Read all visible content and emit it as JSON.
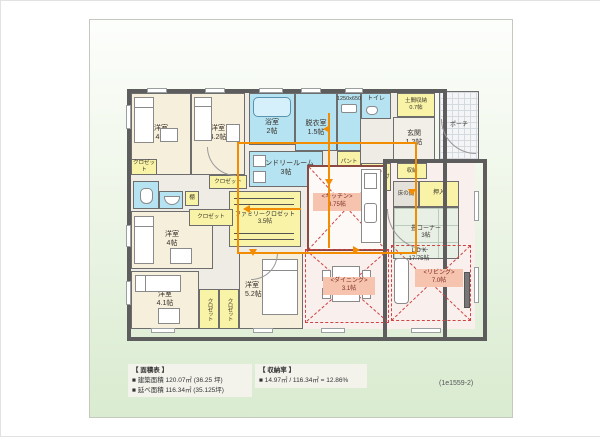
{
  "plan_id": "(1e1559-2)",
  "colors": {
    "wet_area": "#b5e3f2",
    "storage": "#f8f3a6",
    "bedroom": "#f6efdc",
    "ldk_floor": "#f9efec",
    "flow_line": "#f28c00",
    "zone_mark": "#cc4444",
    "wall": "#5d5d5d"
  },
  "rooms": {
    "bedroom_nw": {
      "label": "洋室",
      "size": "4帖"
    },
    "bedroom_n": {
      "label": "洋室",
      "size": "4.2帖"
    },
    "bath": {
      "label": "浴室",
      "size": "2帖"
    },
    "dressing": {
      "label": "脱衣室",
      "size": "1.5帖"
    },
    "vanity": {
      "label": "1250x650"
    },
    "toilet": {
      "label": "トイレ"
    },
    "doma": {
      "label": "土間収納",
      "size": "0.7帖"
    },
    "entry": {
      "label": "玄関",
      "size": "1.2帖"
    },
    "porch": {
      "label": "ポーチ"
    },
    "laundry": {
      "label": "ランドリールーム",
      "size": "3帖"
    },
    "pantry": {
      "label": "パントリー",
      "size": "0.5帖"
    },
    "coat": {
      "label": "コート掛け"
    },
    "shuno": {
      "label": "収納"
    },
    "tokonoma": {
      "label": "床の間"
    },
    "oshiire": {
      "label": "押入"
    },
    "tatami": {
      "label": "畳コーナー",
      "size": "3帖"
    },
    "kitchen": {
      "label": "<キッチン>",
      "size": "3.75帖"
    },
    "family_closet": {
      "label": "ファミリークロゼット",
      "size": "3.5帖"
    },
    "bedroom_w": {
      "label": "洋室",
      "size": "4帖"
    },
    "bedroom_sw": {
      "label": "洋室",
      "size": "4.1帖"
    },
    "bedroom_s": {
      "label": "洋室",
      "size": "5.2帖"
    },
    "ldk": {
      "label": "L D K",
      "size": "17.75帖"
    },
    "dining": {
      "label": "<ダイニング>",
      "size": "3.1帖"
    },
    "living": {
      "label": "<リビング>",
      "size": "7.0帖"
    },
    "closet": {
      "label": "クロゼット"
    },
    "shelf": {
      "label": "棚"
    }
  },
  "legend": {
    "area": {
      "title": "【 面積表 】",
      "rows": [
        {
          "label": "■ 建築面積",
          "value": "120.07㎡ (36.25 坪)"
        },
        {
          "label": "■ 延べ面積",
          "value": "116.34㎡ (35.125坪)"
        }
      ]
    },
    "storage": {
      "title": "【 収納率 】",
      "rows": [
        {
          "label": "■",
          "value": "14.97㎡ / 116.34㎡ = 12.86%"
        }
      ]
    }
  }
}
